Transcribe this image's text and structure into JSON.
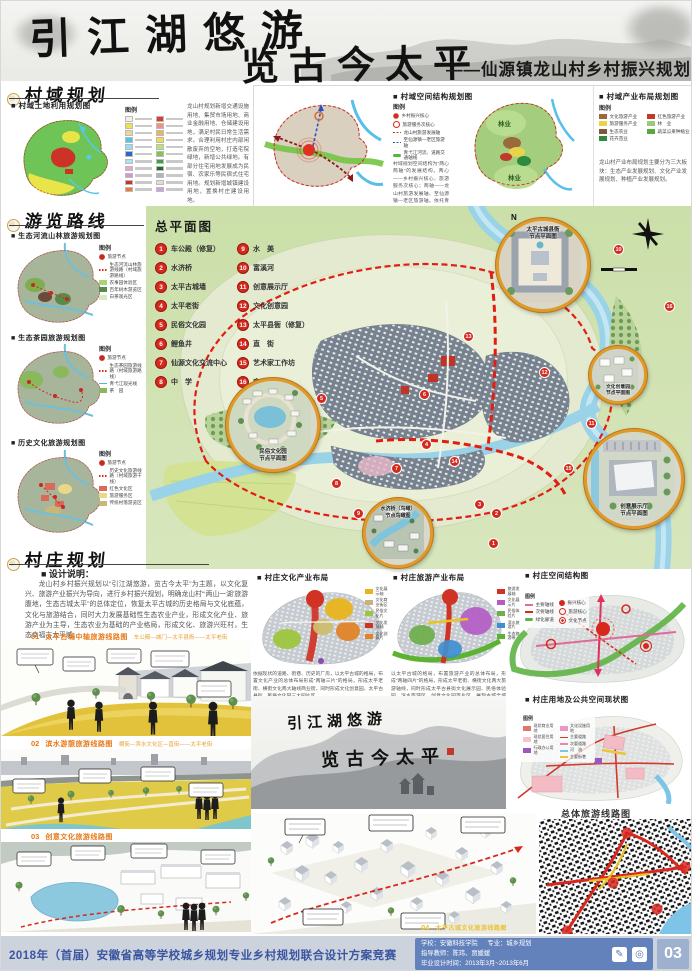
{
  "header": {
    "line1": "引江湖悠游",
    "line2": "览古今太平",
    "subtitle": "——仙源镇龙山村乡村振兴规划"
  },
  "sections": {
    "s1": "村域规划",
    "s2": "游览路线",
    "s3": "村庄规划"
  },
  "land_use": {
    "title": "■ 村域土地利用规划图",
    "legend_title": "图例",
    "colors": [
      {
        "style": "background:#f5f0dc"
      },
      {
        "style": "background:#e8e44a"
      },
      {
        "style": "background:#f2d491"
      },
      {
        "style": "background:#53c3e8"
      },
      {
        "style": "background:#9adcf0"
      },
      {
        "style": "background:#2a66cc"
      },
      {
        "style": "background:#aae4f2"
      },
      {
        "style": "background:#eda4cc"
      },
      {
        "style": "background:#d693dd"
      },
      {
        "style": "background:#cc3326"
      },
      {
        "style": "background:#ec7a35"
      },
      {
        "style": "background:#e23a2e"
      },
      {
        "style": "background:#f29084"
      },
      {
        "style": "background:#efb35d"
      },
      {
        "style": "background:#e9de52"
      },
      {
        "style": "background:#bfe06a"
      },
      {
        "style": "background:#7cc751"
      },
      {
        "style": "background:#3da23b"
      },
      {
        "style": "background:#1d6b2c"
      },
      {
        "style": "background:#b3b3b3"
      },
      {
        "style": "background:#e0ddd2"
      },
      {
        "style": "background:#c9a2e0"
      }
    ],
    "note": "龙山村规划新增交通设施用地、集贸市场用地、商业金融用地、仓储建设用地，满足村民日常生活需求。合理利用村庄内部闲散废弃的空地，打造宅院绿地，新增公共绿地。有部分住宅用地发展成为民宿、农家乐等民宿式住宅用地。规划新增城镇建设用地，置换村庄建设用地。"
  },
  "spatial": {
    "title": "■ 村域空间结构规划图",
    "legend_title": "图例",
    "legend": [
      {
        "label": "乡村振兴核心",
        "sw": "width:6px;height:6px;border-radius:50%;background:radial-gradient(circle,#d42a1e 45%,#f0a89e 75%,transparent 78%)"
      },
      {
        "label": "旅游服务次核心",
        "sw": "width:5px;height:5px;border-radius:50%;border:1.2px solid #d42a1e"
      },
      {
        "label": "龙山村旅游发展轴",
        "sw": "height:1.6px;background:repeating-linear-gradient(90deg,#d42a1e 0 2px,transparent 2px 3.5px)"
      },
      {
        "label": "至仙源镇—老区旅游轴",
        "sw": "height:1.6px;background:repeating-linear-gradient(90deg,#2a50c8 0 2px,transparent 2px 3.5px)"
      },
      {
        "label": "青弋江河流、道路交通轴线",
        "sw": "height:3px;border-radius:2px;background:#52b83c"
      }
    ],
    "note": "村域规划空间结构为“两心两轴”的发展结构。两心——乡村振兴核心、旅游服务次核心；两轴——龙山村旅游发展轴、至仙源镇—老区旅游轴。依托青弋江、道路交通轴线串联村域各旅游节点。"
  },
  "industry": {
    "title": "■ 村域产业布局规划图",
    "legend_title": "图例",
    "forest": "林业",
    "legend": [
      {
        "label": "文化旅游产业",
        "sw": "background:#9a6a3c"
      },
      {
        "label": "旅游服务产业",
        "sw": "background:#e8d44a"
      },
      {
        "label": "生态农业",
        "sw": "background:#7a5a38"
      },
      {
        "label": "花卉苗业",
        "sw": "background:#2e8a3e"
      },
      {
        "label": "红色旅游产业",
        "sw": "background:#c0392b"
      },
      {
        "label": "林　业",
        "sw": "background:#9cc878"
      },
      {
        "label": "蔬菜瓜果种植业",
        "sw": "background:#58a83c"
      }
    ],
    "note": "龙山村产业布局规划主要分为三大板块：生态产业发展规划、文化产业发展规划、种植产业发展规划。"
  },
  "tours": [
    {
      "title": "■ 生态河流山林旅游规划图",
      "legend_title": "图例",
      "legend": [
        {
          "label": "旅游节点",
          "sw": "width:6px;height:6px;border-radius:50%;background:radial-gradient(circle,#c8281e 55%,#e8a098 80%,transparent 82%)"
        },
        {
          "label": "生态河流山林旅游线路（村域旅游路线）",
          "sw": "height:1.5px;background:repeating-linear-gradient(90deg,#d42a1e 0 1.5px,transparent 1.5px 3px)"
        },
        {
          "label": "农事园体验区",
          "sw": "background:#a8d478"
        },
        {
          "label": "百年树木游览区",
          "sw": "background:#5a8a4a"
        },
        {
          "label": "白茶观光区",
          "sw": "background:#d8e8c0"
        }
      ]
    },
    {
      "title": "■ 生态茶园旅游规划图",
      "legend_title": "图例",
      "legend": [
        {
          "label": "旅游节点",
          "sw": "width:6px;height:6px;border-radius:50%;background:radial-gradient(circle,#c8281e 55%,#e8a098 80%,transparent 82%)"
        },
        {
          "label": "生态茶园旅游线路（村域旅游路线）",
          "sw": "height:1.5px;background:repeating-linear-gradient(90deg,#d42a1e 0 1.5px,transparent 1.5px 3px)"
        },
        {
          "label": "青弋江观光线",
          "sw": "height:1.5px;background:#49b8e0"
        },
        {
          "label": "茶　园",
          "sw": "background:#8ab85c"
        }
      ]
    },
    {
      "title": "■ 历史文化旅游规划图",
      "legend_title": "图例",
      "legend": [
        {
          "label": "旅游节点",
          "sw": "width:6px;height:6px;border-radius:50%;background:radial-gradient(circle,#c8281e 55%,#e8a098 80%,transparent 82%)"
        },
        {
          "label": "历史文化旅游线路（村域旅游干线）",
          "sw": "height:1.5px;background:repeating-linear-gradient(90deg,#d42a1e 0 1.5px,transparent 1.5px 3px)"
        },
        {
          "label": "红色文化区",
          "sw": "background:#d86a5a"
        },
        {
          "label": "旅游服务区",
          "sw": "background:#e8d888"
        },
        {
          "label": "传统村落游览区",
          "sw": "background:#c8b878"
        }
      ]
    }
  ],
  "master": {
    "title": "总平面图",
    "north": "N",
    "cols": {
      "left": [
        {
          "no": "1",
          "label": "车公殿（修复）"
        },
        {
          "no": "2",
          "label": "水济桥"
        },
        {
          "no": "3",
          "label": "太平古城墙"
        },
        {
          "no": "4",
          "label": "太平老街"
        },
        {
          "no": "5",
          "label": "民俗文化园"
        },
        {
          "no": "6",
          "label": "鲤鱼井"
        },
        {
          "no": "7",
          "label": "仙源文化交流中心"
        },
        {
          "no": "8",
          "label": "中　学"
        }
      ],
      "right": [
        {
          "no": "9",
          "label": "水　美"
        },
        {
          "no": "10",
          "label": "富溪河"
        },
        {
          "no": "11",
          "label": "创意展示厅"
        },
        {
          "no": "12",
          "label": "文化创意园"
        },
        {
          "no": "13",
          "label": "太平县衙（修复）"
        },
        {
          "no": "14",
          "label": "直　街"
        },
        {
          "no": "15",
          "label": "艺术家工作坊"
        },
        {
          "no": "16",
          "label": "麻川桥"
        }
      ]
    },
    "markers": [
      {
        "no": "1",
        "style": "left:487px;top:537px"
      },
      {
        "no": "2",
        "style": "left:490px;top:507px"
      },
      {
        "no": "3",
        "style": "left:473px;top:498px"
      },
      {
        "no": "4",
        "style": "left:420px;top:438px"
      },
      {
        "no": "5",
        "style": "left:315px;top:392px"
      },
      {
        "no": "6",
        "style": "left:418px;top:388px"
      },
      {
        "no": "7",
        "style": "left:390px;top:462px"
      },
      {
        "no": "8",
        "style": "left:330px;top:477px"
      },
      {
        "no": "9",
        "style": "left:352px;top:507px"
      },
      {
        "no": "10",
        "style": "left:612px;top:243px"
      },
      {
        "no": "11",
        "style": "left:585px;top:417px"
      },
      {
        "no": "12",
        "style": "left:538px;top:366px"
      },
      {
        "no": "13",
        "style": "left:462px;top:330px"
      },
      {
        "no": "14",
        "style": "left:448px;top:455px"
      },
      {
        "no": "15",
        "style": "left:562px;top:462px"
      },
      {
        "no": "16",
        "style": "left:663px;top:300px"
      }
    ],
    "insets": {
      "folk": {
        "l1": "民俗文化园",
        "l2": "节点平面图"
      },
      "county": {
        "l1": "太平古城县衙",
        "l2": "节点平面图"
      },
      "bridge": {
        "l1": "水济桥（鸟瞰）",
        "l2": "节点鸟瞰图"
      },
      "cpark": {
        "l1": "文化创意园",
        "l2": "节点平面图"
      },
      "hall": {
        "l1": "创意展示厅",
        "l2": "节点平面图"
      }
    }
  },
  "design": {
    "title": "■ 设计说明：",
    "text": "龙山村乡村振兴规划以“引江湖悠游，览古今太平”为主题，以文化复兴、旅游产业振兴为导向，进行乡村振兴规划，明确龙山村“‘两山一湖’旅游腹地，生态古城太平”的总体定位，恢复太平古城的历史格局与文化底蕴，文化与旅游结合，同时大力发展基础性生态农业产业，形成文化产业、旅游产业为主导，生态农业为基础的产业格局，形成文化、旅游兴旺村，生态幸福古太平城。"
  },
  "renders": [
    {
      "no": "01",
      "title": "太平古城中轴旅游线路图",
      "route": "车公殿—城门—太平县衙——太平老街"
    },
    {
      "no": "02",
      "title": "滨水游憩旅游线路图",
      "route": "横街—滨水文化区—直街——太平老街"
    },
    {
      "no": "03",
      "title": "创意文化旅游线路图",
      "route": ""
    },
    {
      "no": "04",
      "title": "太平古城文化旅游线路图",
      "route": ""
    }
  ],
  "culture": {
    "title": "■ 村庄文化产业布局",
    "legend": [
      {
        "label": "文化展示轴",
        "sw": "background:#e8b41e"
      },
      {
        "label": "文化商业街区",
        "sw": "background:#c8b27e"
      },
      {
        "label": "民俗文化片",
        "sw": "background:#9ec53e"
      },
      {
        "label": "文化发展轴",
        "sw": "background:#d03224"
      },
      {
        "label": "文化创意片",
        "sw": "background:#e08428"
      }
    ],
    "note": "依据现状的道路、街巷、历史的厂房，以太平古城的格局，布置文化产业的总体布局形成“两轴三片”的格局，形成太平老街、横街文化两大轴线商业街，同时形成文化创意园、太平古县衙、民俗文化园三大园片区。"
  },
  "tourism": {
    "title": "■ 村庄旅游产业布局",
    "legend": [
      {
        "label": "旅游发展轴",
        "sw": "background:#d03224"
      },
      {
        "label": "文化展示片",
        "sw": "background:#b35cc3"
      },
      {
        "label": "民俗体验片",
        "sw": "background:#6fae4a"
      },
      {
        "label": "滨水旅游片",
        "sw": "background:#3f8fd0"
      },
      {
        "label": "生态旅游带",
        "sw": "background:#5cb332"
      }
    ],
    "note": "以太平古城的格局，布置旅游产业的总体布局，形成“两轴四片”的格局，形成太平老街、横街文化两大旅游轴线，同时形成太平古县衙文化展示园、民俗体验园、滨水旅游区、创意文化园等片区，展现古城全域旅游格局。"
  },
  "structure": {
    "title": "■ 村庄空间结构图",
    "legend_title": "图例",
    "lines": [
      {
        "label": "主要轴线",
        "sw": "height:2px;background:#e06a9a"
      },
      {
        "label": "次要轴线",
        "sw": "height:2px;background:#d8281e"
      },
      {
        "label": "绿化廊道",
        "sw": "height:3px;border-radius:2px;background:#5eb344"
      }
    ],
    "nodes": [
      {
        "label": "振兴核心",
        "sw": "width:6px;height:6px;border-radius:50%;background:#d8281e"
      },
      {
        "label": "旅游核心",
        "sw": "width:5px;height:5px;border-radius:50%;border:1.2px solid #d8281e"
      },
      {
        "label": "文化节点",
        "sw": "width:5px;height:5px;border-radius:50%;border:1px solid #d8281e;background:radial-gradient(circle,#d8281e 35%,transparent 40%)"
      }
    ]
  },
  "status": {
    "title": "■ 村庄用地及公共空间现状图",
    "legend_title": "图例",
    "legend": [
      {
        "label": "现状商业用地",
        "sw": "background:#e0776a"
      },
      {
        "label": "现状居住用地",
        "sw": "background:#f4c3cb"
      },
      {
        "label": "行政办公用地",
        "sw": "background:#9a58b8"
      },
      {
        "label": "文化设施用地",
        "sw": "background:#e898c8"
      },
      {
        "label": "主要道路",
        "sw": "height:1.6px;background:#d0392b"
      },
      {
        "label": "次要道路",
        "sw": "height:1.4px;background:#ec86b0"
      },
      {
        "label": "河　流",
        "sw": "height:2px;background:#7ec4e8"
      },
      {
        "label": "主要街巷",
        "sw": "height:2px;background:#e8c838"
      }
    ]
  },
  "overall": {
    "title": "总体旅游线路图"
  },
  "ink": {
    "line1": "引江湖悠游",
    "line2": "览古今太平"
  },
  "footer": {
    "competition": "2018年（首届）安徽省高等学校城乡规划专业乡村规划联合设计方案竞赛",
    "school": "学校：安徽科技学院",
    "major": "专业：城乡规划",
    "advisor": "指导教师：陈玮、贾媛媛",
    "time": "毕业设计时间：2013年3月~2013年6月",
    "page": "03"
  }
}
